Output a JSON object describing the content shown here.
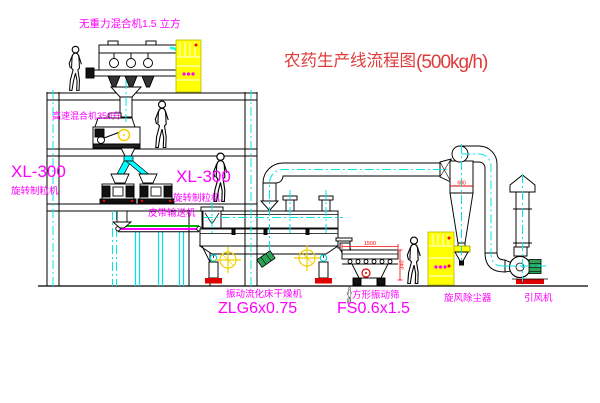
{
  "title": {
    "name": "农药生产线流程图",
    "capacity": "(500kg/h)"
  },
  "labels": {
    "top_mixer": "无重力混合机1.5 立方",
    "high_speed_mixer": "高速混合机350升",
    "granulator_left_model": "XL-300",
    "granulator_left_name": "旋转制粒机",
    "granulator_right_model": "XL-300",
    "granulator_right_name": "旋转制粒机",
    "belt_conveyor": "皮带输送机",
    "dryer_name": "振动流化床干燥机",
    "dryer_model": "ZLG6x0.75",
    "sieve_name": "方形振动筛",
    "sieve_model": "FS0.6x1.5",
    "cyclone_name": "旋风除尘器",
    "fan_name": "引风机"
  },
  "dimensions": {
    "sieve_length": "1500",
    "sieve_height": "340",
    "cyclone_dia": "600"
  },
  "colors": {
    "label_magenta": "#ff00ff",
    "title_red": "#e03a3a",
    "dim_red": "#ff0000",
    "pipe_cyan": "#00ffff",
    "cabinet_yellow": "#ffff00",
    "motor_green": "#2da358",
    "belt_green": "#00b400"
  }
}
